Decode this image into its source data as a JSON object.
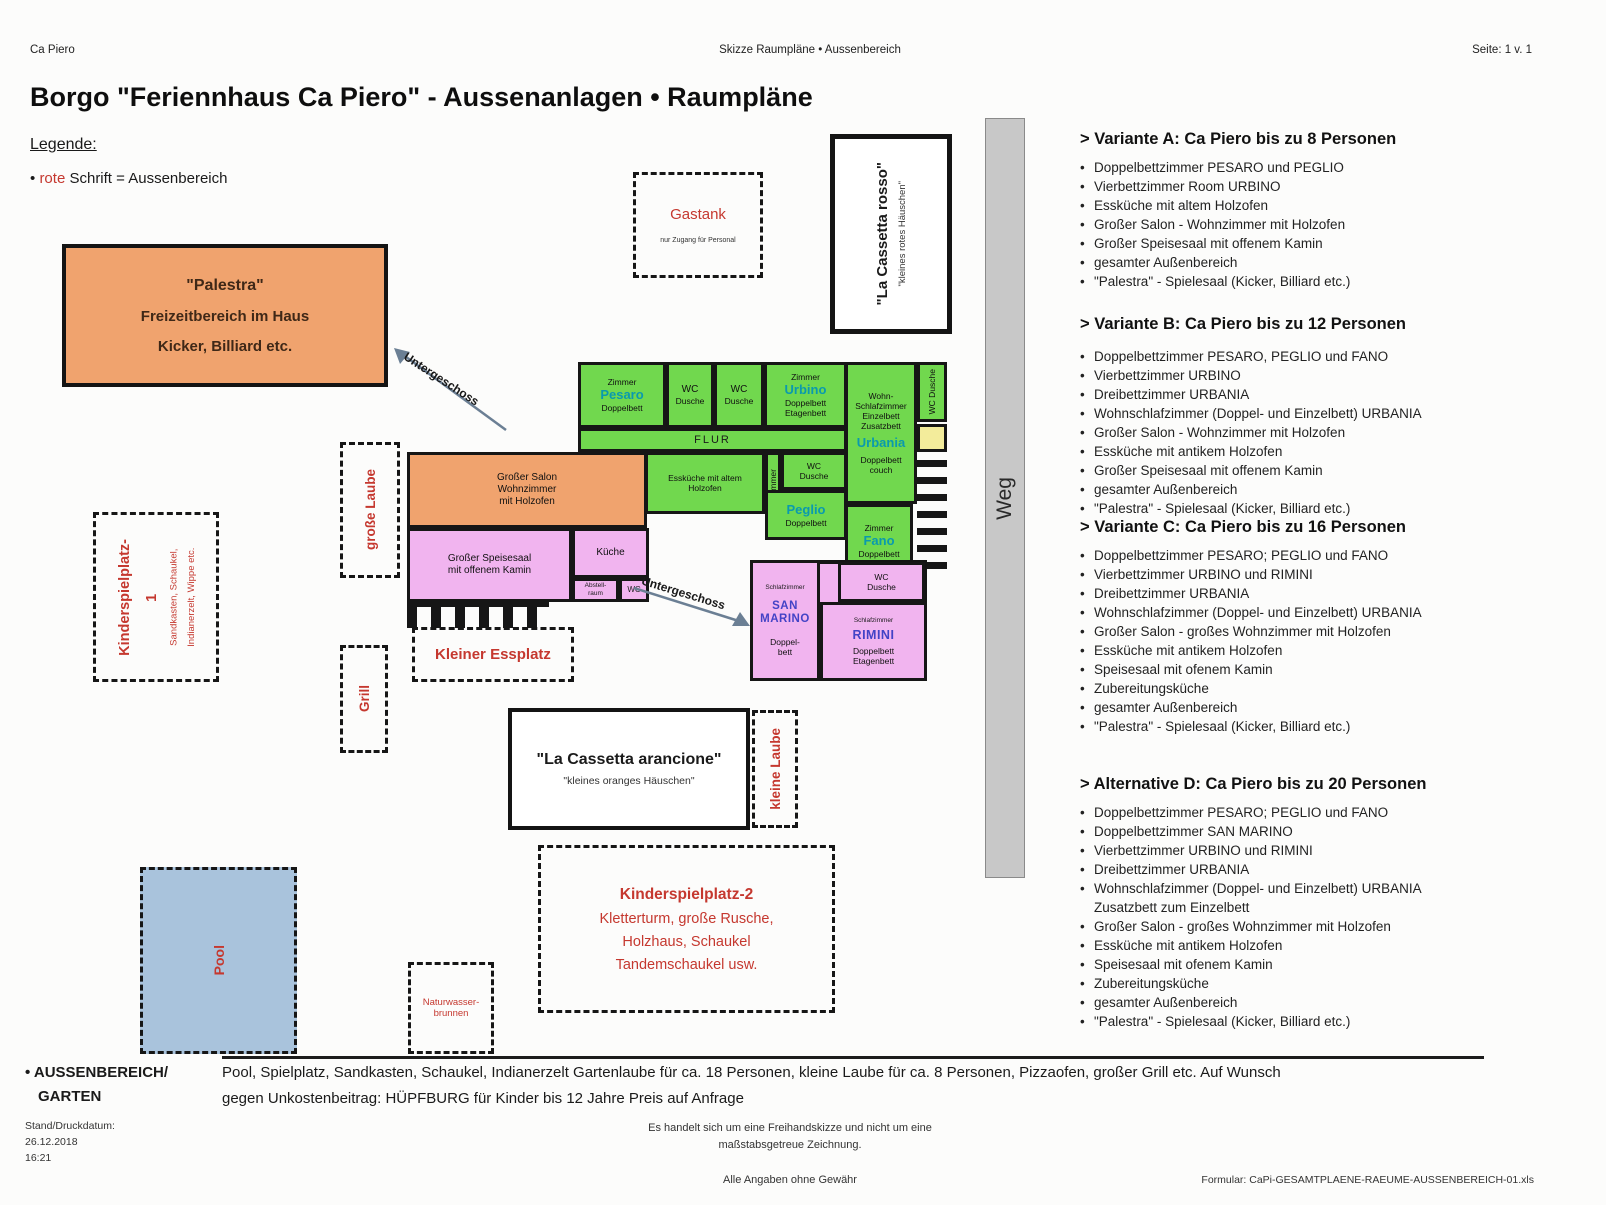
{
  "header": {
    "left": "Ca Piero",
    "center": "Skizze Raumpläne • Aussenbereich",
    "right": "Seite: 1 v. 1",
    "title": "Borgo \"Feriennhaus Ca Piero\" - Aussenanlagen • Raumpläne"
  },
  "legend": {
    "heading": "Legende:",
    "bullet": "•",
    "red_word": "rote",
    "rest": "Schrift = Aussenbereich"
  },
  "palestra": {
    "title": "\"Palestra\"",
    "line2": "Freizeitbereich im Haus",
    "line3": "Kicker, Billiard etc."
  },
  "arrows": {
    "untergeschoss1": "Untergeschoss",
    "untergeschoss2": "Untergeschoss"
  },
  "gastank": {
    "title": "Gastank",
    "note": "nur Zugang für Personal"
  },
  "cassetta_rosso": {
    "title": "\"La Cassetta rosso\"",
    "subtitle": "\"kleines rotes Häuschen\""
  },
  "weg": "Weg",
  "plan": {
    "pesaro": {
      "room": "Zimmer",
      "name": "Pesaro",
      "bed": "Doppelbett"
    },
    "wc_a": {
      "l1": "WC",
      "l2": "Dusche"
    },
    "wc_b": {
      "l1": "WC",
      "l2": "Dusche"
    },
    "urbino": {
      "room": "Zimmer",
      "name": "Urbino",
      "bed1": "Doppelbett",
      "bed2": "Etagenbett"
    },
    "wohnschlaf": {
      "l1": "Wohn-",
      "l2": "Schlafzimmer",
      "l3": "Einzelbett",
      "l4": "Zusatzbett",
      "name": "Urbania",
      "bed": "Doppelbett couch"
    },
    "wc_vert": "WC Dusche",
    "flur": "FLUR",
    "esskueche": {
      "l1": "Essküche mit altem",
      "l2": "Holzofen"
    },
    "zimmer_vert": "Zimmer",
    "wc_small": {
      "l1": "WC",
      "l2": "Dusche"
    },
    "peglio": {
      "name": "Peglio",
      "bed": "Doppelbett"
    },
    "fano": {
      "room": "Zimmer",
      "name": "Fano",
      "bed": "Doppelbett"
    },
    "salon": {
      "l1": "Großer Salon",
      "l2": "Wohnzimmer",
      "l3": "mit Holzofen"
    },
    "speisesaal": {
      "l1": "Großer Speisesaal",
      "l2": "mit offenem Kamin"
    },
    "kueche": "Küche",
    "abstell": {
      "l1": "Abstell-",
      "l2": "raum"
    },
    "wc_mini": "WC",
    "san_marino": {
      "room": "Schlafzimmer",
      "name1": "SAN",
      "name2": "MARINO",
      "bed1": "Doppel-",
      "bed2": "bett"
    },
    "wc_pink": {
      "l1": "WC",
      "l2": "Dusche"
    },
    "rimini": {
      "room": "Schlafzimmer",
      "name": "RIMINI",
      "bed1": "Doppelbett",
      "bed2": "Etagenbett"
    }
  },
  "outdoor": {
    "grosse_laube": "große Laube",
    "kinderspielplatz1": {
      "t1": "Kinderspielplatz-",
      "t2": "1",
      "s1": "Sandkasten, Schaukel,",
      "s2": "Indianerzelt, Wippe etc."
    },
    "grill": "Grill",
    "kleiner_essplatz": "Kleiner Essplatz",
    "cassetta_arancione": {
      "title": "\"La Cassetta arancione\"",
      "subtitle": "\"kleines oranges Häuschen\""
    },
    "kleine_laube": "kleine Laube",
    "kinderspielplatz2": {
      "title": "Kinderspielplatz-2",
      "l2": "Kletterturm, große Rusche,",
      "l3": "Holzhaus, Schaukel",
      "l4": "Tandemschaukel usw."
    },
    "brunnen": {
      "l1": "Naturwasser-",
      "l2": "brunnen"
    },
    "pool": "Pool"
  },
  "variants": [
    {
      "title": "> Variante A: Ca Piero bis zu 8 Personen",
      "items": [
        {
          "b": "•",
          "t": "Doppelbettzimmer PESARO und PEGLIO"
        },
        {
          "b": "•",
          "t": "Vierbettzimmer Room URBINO"
        },
        {
          "b": "•",
          "t": "Essküche mit altem Holzofen"
        },
        {
          "b": "•",
          "t": "Großer Salon - Wohnzimmer mit Holzofen"
        },
        {
          "b": "•",
          "t": "Großer Speisesaal mit offenem Kamin"
        },
        {
          "b": "•",
          "t": "gesamter Außenbereich"
        },
        {
          "b": "•",
          "t": "\"Palestra\" - Spielesaal (Kicker, Billiard etc.)"
        }
      ]
    },
    {
      "title": "> Variante B: Ca Piero bis zu 12 Personen",
      "items": [
        {
          "b": "•",
          "t": "Doppelbettzimmer PESARO, PEGLIO und FANO"
        },
        {
          "b": "•",
          "t": "Vierbettzimmer URBINO"
        },
        {
          "b": "•",
          "t": "Dreibettzimmer URBANIA"
        },
        {
          "b": "•",
          "t": "Wohnschlafzimmer (Doppel- und Einzelbett) URBANIA"
        },
        {
          "b": "•",
          "t": "Großer Salon - Wohnzimmer mit Holzofen"
        },
        {
          "b": "•",
          "t": "Essküche mit antikem Holzofen"
        },
        {
          "b": "•",
          "t": "Großer Speisesaal mit offenem Kamin"
        },
        {
          "b": "•",
          "t": "gesamter Außenbereich"
        },
        {
          "b": "•",
          "t": "\"Palestra\" - Spielesaal (Kicker, Billiard etc.)"
        }
      ]
    },
    {
      "title": "> Variante C: Ca Piero bis zu 16 Personen",
      "items": [
        {
          "b": "•",
          "t": "Doppelbettzimmer PESARO; PEGLIO und FANO"
        },
        {
          "b": "•",
          "t": "Vierbettzimmer URBINO und RIMINI"
        },
        {
          "b": "•",
          "t": "Dreibettzimmer URBANIA"
        },
        {
          "b": "•",
          "t": "Wohnschlafzimmer (Doppel- und Einzelbett) URBANIA"
        },
        {
          "b": "•",
          "t": "Großer Salon - großes Wohnzimmer mit Holzofen"
        },
        {
          "b": "•",
          "t": "Essküche mit antikem Holzofen"
        },
        {
          "b": "•",
          "t": "Speisesaal mit ofenem Kamin"
        },
        {
          "b": "•",
          "t": "Zubereitungsküche"
        },
        {
          "b": "•",
          "t": "gesamter Außenbereich"
        },
        {
          "b": "•",
          "t": "\"Palestra\" - Spielesaal (Kicker, Billiard etc.)"
        }
      ]
    },
    {
      "title": "> Alternative D: Ca Piero bis zu 20 Personen",
      "items": [
        {
          "b": "•",
          "t": "Doppelbettzimmer PESARO; PEGLIO und FANO"
        },
        {
          "b": "•",
          "t": "Doppelbettzimmer SAN MARINO"
        },
        {
          "b": "•",
          "t": "Vierbettzimmer URBINO und RIMINI"
        },
        {
          "b": "•",
          "t": "Dreibettzimmer URBANIA"
        },
        {
          "b": "•",
          "t": "Wohnschlafzimmer (Doppel- und Einzelbett) URBANIA"
        },
        {
          "b": "",
          "t": "Zusatzbett zum Einzelbett"
        },
        {
          "b": "•",
          "t": "Großer Salon - großes Wohnzimmer mit Holzofen"
        },
        {
          "b": "•",
          "t": "Essküche mit antikem Holzofen"
        },
        {
          "b": "•",
          "t": "Speisesaal mit ofenem Kamin"
        },
        {
          "b": "•",
          "t": "Zubereitungsküche"
        },
        {
          "b": "•",
          "t": "gesamter Außenbereich"
        },
        {
          "b": "•",
          "t": "\"Palestra\" - Spielesaal (Kicker, Billiard etc.)"
        }
      ]
    }
  ],
  "footer": {
    "aussen1": "• AUSSENBEREICH/",
    "aussen2": "GARTEN",
    "desc1": "Pool, Spielplatz, Sandkasten, Schaukel, Indianerzelt  Gartenlaube für ca. 18 Personen, kleine Laube für  ca. 8 Personen, Pizzaofen, großer Grill etc. Auf Wunsch",
    "desc2": "gegen Unkostenbeitrag:  HÜPFBURG für Kinder bis 12 Jahre Preis auf Anfrage",
    "stand1": "Stand/Druckdatum:",
    "stand2": "26.12.2018",
    "stand3": "16:21",
    "note1": "Es handelt sich um eine Freihandskizze und nicht um eine",
    "note2": "maßstabsgetreue Zeichnung.",
    "gewaehr": "Alle Angaben ohne Gewähr",
    "formular": "Formular: CaPi-GESAMTPLAENE-RAEUME-AUSSENBEREICH-01.xls"
  },
  "colors": {
    "green_room": "#71d84e",
    "pink_room": "#f1b4ef",
    "orange_room": "#f0a36e",
    "pool_blue": "#a9c3dc",
    "weg_gray": "#c8c8c8",
    "accent_red": "#c5382f",
    "teal_name": "#0a9aae",
    "blue_name": "#4343c6"
  }
}
